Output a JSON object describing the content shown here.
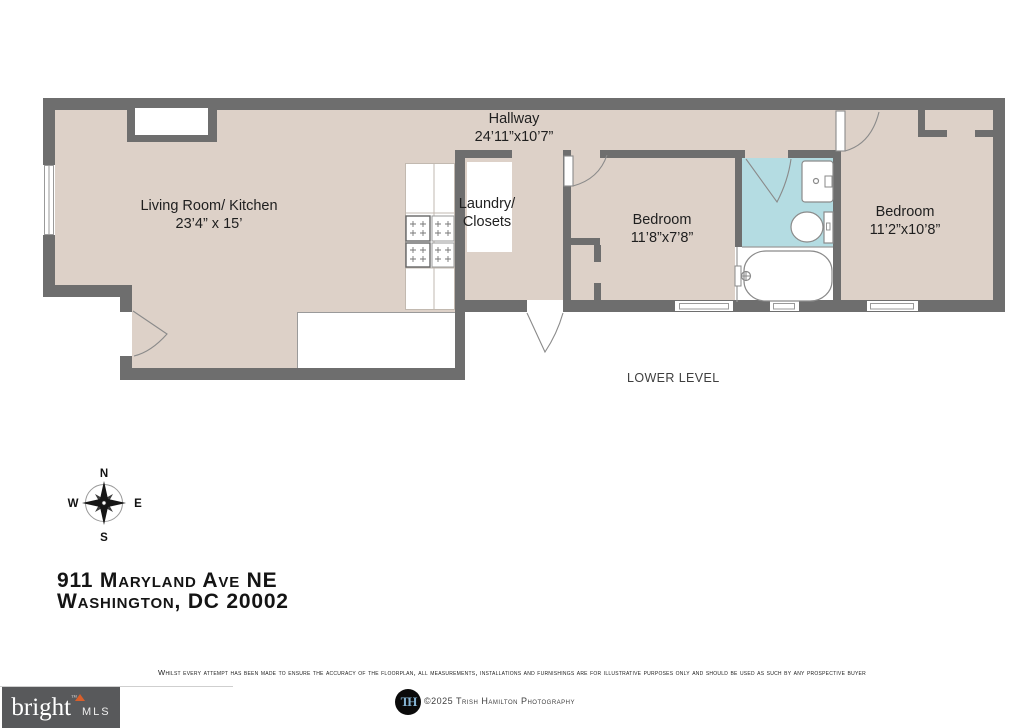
{
  "floorplan": {
    "level_label": "LOWER LEVEL",
    "rooms": {
      "hallway": {
        "name": "Hallway",
        "dims": "24’11”x10’7”"
      },
      "living": {
        "name": "Living Room/ Kitchen",
        "dims": "23’4” x 15’"
      },
      "laundry": {
        "name_line1": "Laundry/",
        "name_line2": "Closets"
      },
      "bedroom1": {
        "name": "Bedroom",
        "dims": "11’8”x7’8”"
      },
      "bedroom2": {
        "name": "Bedroom",
        "dims": "11’2”x10’8”"
      }
    },
    "colors": {
      "wall": "#6e6e6e",
      "floor": "#ddd1c8",
      "bath": "#b4dce2"
    }
  },
  "compass": {
    "n": "N",
    "s": "S",
    "e": "E",
    "w": "W"
  },
  "address": {
    "line1": "911 Maryland Ave NE",
    "line2": "Washington, DC 20002"
  },
  "disclaimer": "Whilst every attempt has been made to ensure the accuracy of the floorplan, all measurements, installations and furnishings are for illustrative purposes only and should be used as such by any prospective buyer",
  "footer": {
    "brand": {
      "name": "bright",
      "tm": "™",
      "suffix": "MLS"
    },
    "monogram": "TH",
    "credit": "©2025 Trish Hamilton Photography"
  }
}
